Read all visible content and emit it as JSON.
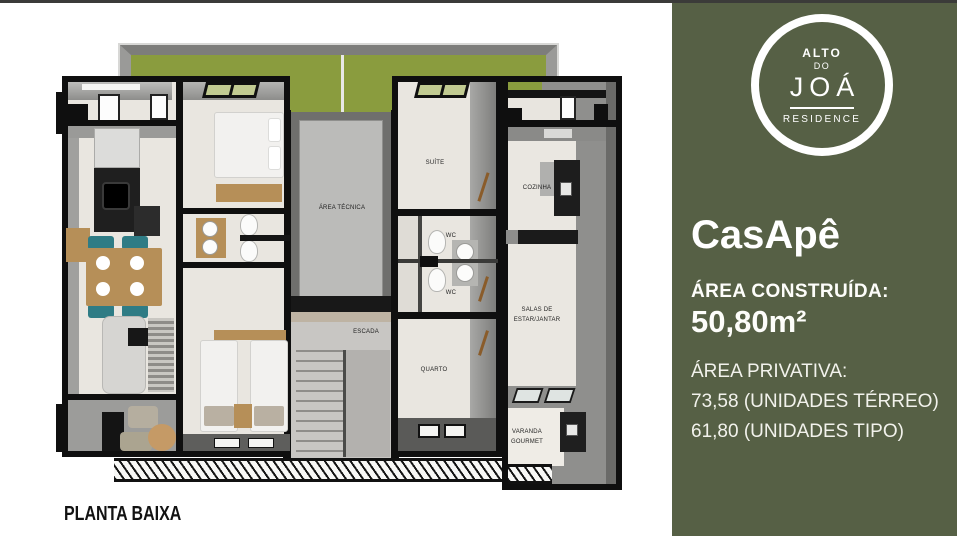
{
  "plan": {
    "caption": "PLANTA BAIXA",
    "labels": {
      "area_tecnica": "ÁREA TÉCNICA",
      "escada": "ESCADA",
      "suite": "SUÍTE",
      "wc1": "WC",
      "wc2": "WC",
      "quarto": "QUARTO",
      "cozinha": "COZINHA",
      "salas1": "SALAS DE",
      "salas2": "ESTAR/JANTAR",
      "varanda1": "VARANDA",
      "varanda2": "GOURMET"
    }
  },
  "panel": {
    "logo": {
      "top": "ALTO",
      "mid": "DO",
      "name": "JOÁ",
      "bottom": "RESIDENCE"
    },
    "title": "CasApê",
    "built_label": "ÁREA CONSTRUÍDA:",
    "built_value": "50,80m²",
    "private_label": "ÁREA PRIVATIVA:",
    "private_line1": "73,58 (UNIDADES TÉRREO)",
    "private_line2": "61,80 (UNIDADES TIPO)"
  },
  "colors": {
    "panel_bg": "#566045",
    "grass_green": "#8a9c3e",
    "wall_black": "#0f0f0f",
    "floor_beige": "#e9e6e0"
  }
}
